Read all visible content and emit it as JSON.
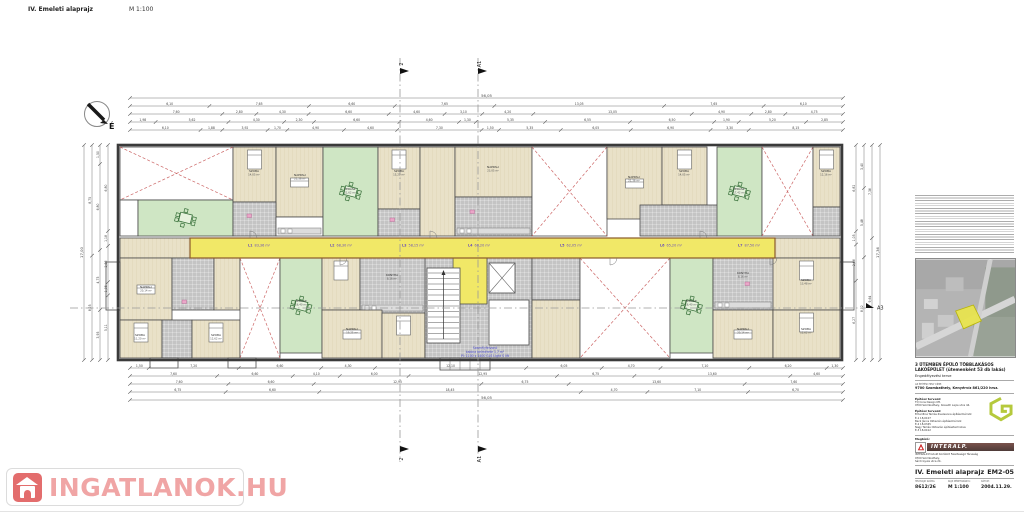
{
  "header": {
    "title": "IV. Emeleti alaprajz",
    "scale": "M 1:100"
  },
  "compass": {
    "label": "É"
  },
  "sections": {
    "y0": 58,
    "y1": 462,
    "verticals": [
      {
        "x": 400,
        "label": "2"
      },
      {
        "x": 478,
        "label": "A1"
      }
    ],
    "horizontal": {
      "y": 308,
      "x0": 70,
      "x1": 866,
      "label": "A3"
    }
  },
  "corridor_labels": [
    {
      "x": 248,
      "t": "L1",
      "a": "83,36 m²"
    },
    {
      "x": 330,
      "t": "L2",
      "a": "68,30 m²"
    },
    {
      "x": 402,
      "t": "L3",
      "a": "58,15 m²"
    },
    {
      "x": 468,
      "t": "L4",
      "a": "60,20 m²"
    },
    {
      "x": 560,
      "t": "L5",
      "a": "62,05 m²"
    },
    {
      "x": 660,
      "t": "L6",
      "a": "65,20 m²"
    },
    {
      "x": 738,
      "t": "L7",
      "a": "87,50 m²"
    }
  ],
  "room_labels": [
    {
      "x": 254,
      "y": 172,
      "n": "SZOBA",
      "a": "14,05 m²"
    },
    {
      "x": 300,
      "y": 176,
      "n": "NAPPALI",
      "a": "21,36 m²"
    },
    {
      "x": 350,
      "y": 190,
      "n": "TERASZ",
      "a": "21,62 m²"
    },
    {
      "x": 399,
      "y": 172,
      "n": "SZOBA",
      "a": "15,20 m²"
    },
    {
      "x": 493,
      "y": 168,
      "n": "NAPPALI",
      "a": "23,05 m²"
    },
    {
      "x": 634,
      "y": 178,
      "n": "NAPPALI",
      "a": "21,36 m²"
    },
    {
      "x": 684,
      "y": 172,
      "n": "SZOBA",
      "a": "14,05 m²"
    },
    {
      "x": 739,
      "y": 190,
      "n": "TERASZ",
      "a": "17,42 m²"
    },
    {
      "x": 826,
      "y": 172,
      "n": "SZOBA",
      "a": "12,16 m²"
    },
    {
      "x": 146,
      "y": 288,
      "n": "NAPPALI",
      "a": "20,14 m²"
    },
    {
      "x": 140,
      "y": 336,
      "n": "SZOBA",
      "a": "11,20 m²"
    },
    {
      "x": 216,
      "y": 336,
      "n": "SZOBA",
      "a": "12,62 m²"
    },
    {
      "x": 301,
      "y": 302,
      "n": "TERASZ",
      "a": "16,40 m²"
    },
    {
      "x": 352,
      "y": 330,
      "n": "NAPPALI",
      "a": "19,25 m²"
    },
    {
      "x": 392,
      "y": 276,
      "n": "KONYHA",
      "a": "8,16 m²"
    },
    {
      "x": 691,
      "y": 302,
      "n": "TERASZ",
      "a": "16,40 m²"
    },
    {
      "x": 743,
      "y": 274,
      "n": "KONYHA",
      "a": "8,16 m²"
    },
    {
      "x": 806,
      "y": 281,
      "n": "SZOBA",
      "a": "13,48 m²"
    },
    {
      "x": 743,
      "y": 330,
      "n": "NAPPALI",
      "a": "20,14 m²"
    },
    {
      "x": 806,
      "y": 330,
      "n": "SZOBA",
      "a": "12,62 m²"
    }
  ],
  "note_center": {
    "x": 485,
    "y": 349,
    "lines": [
      "Személyfelvonó",
      "kabina belmérete 1,7 m²",
      "Pl: 1100 x 1400 GLS Light S lift"
    ]
  },
  "dims": {
    "h_rows": [
      {
        "y": 98,
        "x0": 130,
        "x1": 843,
        "values": [
          "56,05"
        ]
      },
      {
        "y": 106,
        "x0": 130,
        "x1": 843,
        "values": [
          "6,10",
          "7,65",
          "6,60",
          "7,65",
          "13,05",
          "7,65",
          "6,10"
        ]
      },
      {
        "y": 114,
        "x0": 130,
        "x1": 843,
        "values": [
          "7,60",
          "2,80",
          "4,30",
          "6,60",
          "4,60",
          "3,10",
          "4,20",
          "13,05",
          "4,90",
          "2,80",
          "4,75"
        ]
      },
      {
        "y": 122,
        "x0": 130,
        "x1": 843,
        "values": [
          "1,98",
          "5,62",
          "4,30",
          "2,30",
          "6,60",
          "4,60",
          "1,30",
          "5,35",
          "6,55",
          "6,50",
          "1,90",
          "5,20",
          "2,85"
        ]
      },
      {
        "y": 130,
        "x0": 130,
        "x1": 843,
        "values": [
          "6,10",
          "1,88",
          "3,92",
          "1,70",
          "4,90",
          "4,60",
          "7,30",
          "1,50",
          "5,35",
          "6,05",
          "6,90",
          "3,30",
          "8,15"
        ]
      },
      {
        "y": 368,
        "x0": 130,
        "x1": 843,
        "values": [
          "1,50",
          "7,20",
          "6,60",
          "4,30",
          "12,10",
          "6,05",
          "4,70",
          "7,10",
          "6,20",
          "1,30"
        ]
      },
      {
        "y": 376,
        "x0": 130,
        "x1": 843,
        "values": [
          "7,60",
          "6,60",
          "4,10",
          "6,00",
          "12,95",
          "6,75",
          "13,60",
          "4,60"
        ]
      },
      {
        "y": 384,
        "x0": 130,
        "x1": 843,
        "values": [
          "7,60",
          "6,60",
          "12,95",
          "6,75",
          "13,60",
          "7,60"
        ]
      },
      {
        "y": 392,
        "x0": 130,
        "x1": 843,
        "values": [
          "6,75",
          "6,60",
          "18,45",
          "4,70",
          "7,10",
          "6,70"
        ]
      },
      {
        "y": 400,
        "x0": 130,
        "x1": 843,
        "values": [
          "56,05"
        ]
      }
    ],
    "v_rows": [
      {
        "x": 84,
        "y0": 145,
        "y1": 360,
        "values": [
          "17,00"
        ]
      },
      {
        "x": 92,
        "y0": 145,
        "y1": 360,
        "values": [
          "8,75",
          "8,25"
        ]
      },
      {
        "x": 100,
        "y0": 145,
        "y1": 360,
        "values": [
          "1,50",
          "6,80",
          "4,75",
          "3,95"
        ]
      },
      {
        "x": 108,
        "y0": 145,
        "y1": 360,
        "values": [
          "6,80",
          "1,18",
          "2,86",
          "1,05",
          "5,11"
        ]
      },
      {
        "x": 856,
        "y0": 145,
        "y1": 360,
        "values": [
          "6,82",
          "1,05",
          "2,86",
          "6,27"
        ]
      },
      {
        "x": 864,
        "y0": 145,
        "y1": 360,
        "values": [
          "3,40",
          "5,48",
          "8,12"
        ]
      },
      {
        "x": 872,
        "y0": 145,
        "y1": 360,
        "values": [
          "7,36",
          "9,64"
        ]
      },
      {
        "x": 880,
        "y0": 145,
        "y1": 360,
        "values": [
          "17,36"
        ]
      }
    ]
  },
  "plan": {
    "outline": {
      "x": 118,
      "y": 145,
      "w": 724,
      "h": 215
    },
    "corridor": {
      "x": 190,
      "y": 238,
      "w": 585,
      "h": 20
    },
    "rooms": [
      {
        "t": "roof",
        "x": 120,
        "y": 147,
        "w": 113,
        "h": 53
      },
      {
        "t": "white",
        "x": 120,
        "y": 200,
        "w": 18,
        "h": 36
      },
      {
        "t": "terrace",
        "x": 138,
        "y": 200,
        "w": 95,
        "h": 36,
        "f": "table"
      },
      {
        "t": "parquet",
        "x": 233,
        "y": 147,
        "w": 43,
        "h": 55,
        "f": "bed"
      },
      {
        "t": "parquet",
        "x": 276,
        "y": 147,
        "w": 47,
        "h": 70,
        "f": "sofa"
      },
      {
        "t": "tile",
        "x": 233,
        "y": 202,
        "w": 43,
        "h": 34
      },
      {
        "t": "white",
        "x": 276,
        "y": 217,
        "w": 47,
        "h": 19,
        "f": "counter"
      },
      {
        "t": "terrace",
        "x": 323,
        "y": 147,
        "w": 55,
        "h": 89,
        "f": "table"
      },
      {
        "t": "parquet",
        "x": 378,
        "y": 147,
        "w": 42,
        "h": 62,
        "f": "bed"
      },
      {
        "t": "tile",
        "x": 378,
        "y": 209,
        "w": 42,
        "h": 27
      },
      {
        "t": "parquet",
        "x": 420,
        "y": 147,
        "w": 35,
        "h": 89
      },
      {
        "t": "parquet",
        "x": 455,
        "y": 147,
        "w": 77,
        "h": 50
      },
      {
        "t": "tile",
        "x": 455,
        "y": 197,
        "w": 77,
        "h": 39,
        "f": "counter"
      },
      {
        "t": "roof",
        "x": 532,
        "y": 147,
        "w": 75,
        "h": 89
      },
      {
        "t": "parquet",
        "x": 607,
        "y": 147,
        "w": 55,
        "h": 72,
        "f": "sofa"
      },
      {
        "t": "parquet",
        "x": 662,
        "y": 147,
        "w": 45,
        "h": 58,
        "f": "bed"
      },
      {
        "t": "tile",
        "x": 640,
        "y": 205,
        "w": 77,
        "h": 31
      },
      {
        "t": "terrace",
        "x": 717,
        "y": 147,
        "w": 45,
        "h": 89,
        "f": "table"
      },
      {
        "t": "roof",
        "x": 762,
        "y": 147,
        "w": 51,
        "h": 89
      },
      {
        "t": "parquet",
        "x": 813,
        "y": 147,
        "w": 27,
        "h": 60,
        "f": "bed"
      },
      {
        "t": "tile",
        "x": 813,
        "y": 207,
        "w": 27,
        "h": 29
      },
      {
        "t": "parquet",
        "x": 120,
        "y": 238,
        "w": 70,
        "h": 20
      },
      {
        "t": "parquet",
        "x": 775,
        "y": 238,
        "w": 65,
        "h": 20
      },
      {
        "t": "parquet",
        "x": 120,
        "y": 258,
        "w": 52,
        "h": 62,
        "f": "sofa"
      },
      {
        "t": "tile",
        "x": 172,
        "y": 258,
        "w": 42,
        "h": 52
      },
      {
        "t": "parquet",
        "x": 214,
        "y": 258,
        "w": 26,
        "h": 52
      },
      {
        "t": "parquet",
        "x": 120,
        "y": 320,
        "w": 42,
        "h": 38,
        "f": "bed"
      },
      {
        "t": "tile",
        "x": 162,
        "y": 320,
        "w": 30,
        "h": 38
      },
      {
        "t": "parquet",
        "x": 192,
        "y": 320,
        "w": 48,
        "h": 38,
        "f": "bed"
      },
      {
        "t": "roof",
        "x": 240,
        "y": 258,
        "w": 40,
        "h": 100
      },
      {
        "t": "terrace",
        "x": 280,
        "y": 258,
        "w": 42,
        "h": 95,
        "f": "table"
      },
      {
        "t": "parquet",
        "x": 322,
        "y": 258,
        "w": 38,
        "h": 52,
        "f": "bed"
      },
      {
        "t": "tile",
        "x": 360,
        "y": 258,
        "w": 65,
        "h": 55,
        "f": "counter"
      },
      {
        "t": "parquet",
        "x": 322,
        "y": 310,
        "w": 60,
        "h": 48,
        "f": "sofa"
      },
      {
        "t": "parquet",
        "x": 382,
        "y": 313,
        "w": 43,
        "h": 45,
        "f": "bed"
      },
      {
        "t": "tile",
        "x": 425,
        "y": 258,
        "w": 107,
        "h": 100
      },
      {
        "t": "yellow",
        "x": 453,
        "y": 258,
        "w": 34,
        "h": 46
      },
      {
        "t": "white",
        "x": 427,
        "y": 268,
        "w": 33,
        "h": 75,
        "f": "stairs"
      },
      {
        "t": "white",
        "x": 489,
        "y": 263,
        "w": 26,
        "h": 30,
        "f": "lift"
      },
      {
        "t": "white",
        "x": 489,
        "y": 300,
        "w": 40,
        "h": 45
      },
      {
        "t": "tile",
        "x": 532,
        "y": 258,
        "w": 48,
        "h": 42
      },
      {
        "t": "parquet",
        "x": 532,
        "y": 300,
        "w": 48,
        "h": 58
      },
      {
        "t": "roof",
        "x": 580,
        "y": 258,
        "w": 90,
        "h": 100
      },
      {
        "t": "terrace",
        "x": 670,
        "y": 258,
        "w": 43,
        "h": 95,
        "f": "table"
      },
      {
        "t": "tile",
        "x": 713,
        "y": 258,
        "w": 60,
        "h": 52,
        "f": "counter"
      },
      {
        "t": "parquet",
        "x": 773,
        "y": 258,
        "w": 67,
        "h": 52,
        "f": "bed"
      },
      {
        "t": "parquet",
        "x": 713,
        "y": 310,
        "w": 60,
        "h": 48,
        "f": "sofa"
      },
      {
        "t": "parquet",
        "x": 773,
        "y": 310,
        "w": 67,
        "h": 48,
        "f": "bed"
      },
      {
        "t": "white",
        "x": 106,
        "y": 262,
        "w": 14,
        "h": 48
      },
      {
        "t": "white",
        "x": 840,
        "y": 262,
        "w": 14,
        "h": 48
      },
      {
        "t": "white",
        "x": 150,
        "y": 358,
        "w": 28,
        "h": 10
      },
      {
        "t": "white",
        "x": 228,
        "y": 358,
        "w": 28,
        "h": 10
      },
      {
        "t": "white",
        "x": 440,
        "y": 358,
        "w": 50,
        "h": 12,
        "f": "steps"
      }
    ],
    "doors": [
      {
        "x": 250,
        "y": 238,
        "o": 0
      },
      {
        "x": 340,
        "y": 258,
        "o": 1
      },
      {
        "x": 430,
        "y": 238,
        "o": 0
      },
      {
        "x": 610,
        "y": 258,
        "o": 1
      },
      {
        "x": 700,
        "y": 238,
        "o": 0
      },
      {
        "x": 770,
        "y": 258,
        "o": 1
      }
    ],
    "accents": [
      {
        "x": 247,
        "y": 214
      },
      {
        "x": 390,
        "y": 218
      },
      {
        "x": 182,
        "y": 300
      },
      {
        "x": 745,
        "y": 282
      },
      {
        "x": 470,
        "y": 210
      }
    ],
    "colors": {
      "corridor": "#f1e867",
      "terrace": "#cfe6c4",
      "roof_dash": "#cc6666",
      "wall": "#3a3a3a",
      "wall_accent": "#8a5a2a",
      "accent_pink": "#eba6c8",
      "label_purple": "#6a4fb8",
      "note_blue": "#4848c8"
    }
  },
  "notes_panel": {
    "description": "apróbetűs műszaki megjegyzések"
  },
  "titleblock": {
    "project_title": "3 ÜTEMBEN ÉPÜLŐ TÖBBLAKÁSOS LAKÓÉPÜLET (ütemenként 53 db lakás)",
    "project_subtitle": "Engedélyezési terve",
    "site_label": "AZ ÉPÍTÉSI HELY CÍME:",
    "site_address": "9700 Szombathely, Kenyérvíz 861/220 hrsz.",
    "architect1_label": "Építész tervező:",
    "architect1_line1": "TQ Cons Design Kft.",
    "architect1_line2": "9700 Szombathely, Kossuth Lajos utca 44.",
    "architect2_label": "Építész tervező:",
    "architect2_line1": "Erhardtné Tamás Zsuzsanna építészmérnök",
    "architect2_line2": "É-1 18-0107",
    "staff1_line1": "Beck János Oktavián építészmérnök",
    "staff1_line2": "É-2 18-0345",
    "staff2_line1": "Nagy Tamás Oktavián építésztechnikus",
    "staff2_line2": "É-3 18-0412",
    "client_label": "Megbízó:",
    "client_logo_text": "INTERALP.",
    "client_line1": "INTERALP-Produkt Korlátolt Felelősségű Társaság",
    "client_line2": "9700 Szombathely,",
    "client_line3": "Sárdi Gyula utca 24.",
    "drawing_title": "IV. Emeleti alaprajz",
    "drawing_number": "EM2-05",
    "col1_label": "HELYRAJZI SZÁMA:",
    "col1_value": "8612/26",
    "col2_label": "RAJZ MÉRETARÁNYA:",
    "col2_value": "M 1:100",
    "col3_label": "DÁTUM:",
    "col3_value": "2004.11.29."
  },
  "watermark": {
    "text": "INGATLANOK.HU"
  }
}
